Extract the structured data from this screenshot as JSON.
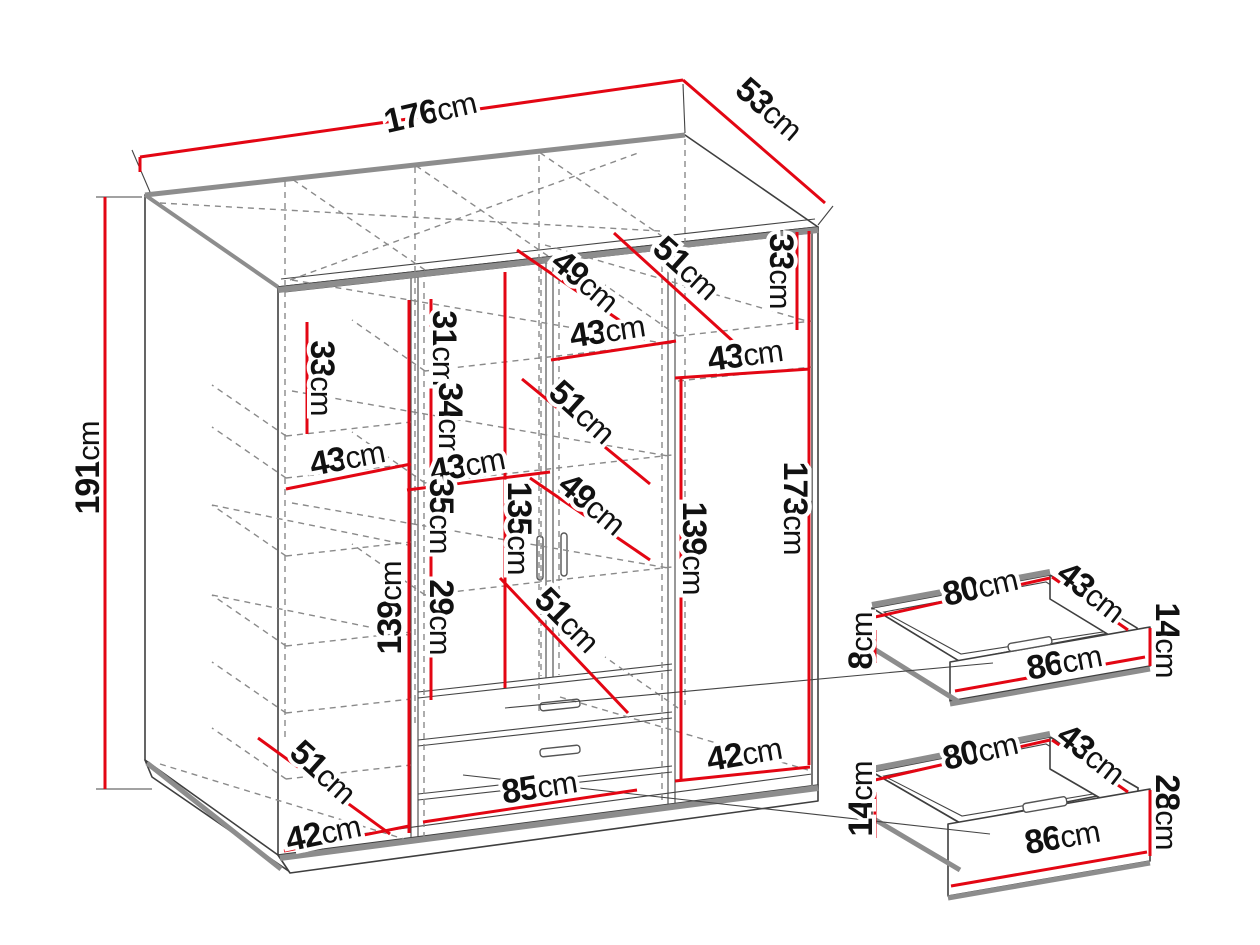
{
  "figure": {
    "kind": "furniture-dimension-diagram",
    "subject": "three-door wardrobe with two drawers and two drawer detail views",
    "unit": "cm"
  },
  "colors": {
    "dimension_red": "#e30613",
    "outline": "#3f3f3f",
    "shadow_gray": "#8d8d8d",
    "dash_gray": "#8a8a8a",
    "background": "#ffffff",
    "text": "#111111"
  },
  "dimensions": [
    {
      "id": "overall-width",
      "value": "176",
      "unit": "cm"
    },
    {
      "id": "overall-depth",
      "value": "53",
      "unit": "cm"
    },
    {
      "id": "overall-height",
      "value": "191",
      "unit": "cm"
    },
    {
      "id": "left-top-compartment-height",
      "value": "33",
      "unit": "cm"
    },
    {
      "id": "left-shelf-width",
      "value": "43",
      "unit": "cm"
    },
    {
      "id": "left-floor-diagonal",
      "value": "51",
      "unit": "cm"
    },
    {
      "id": "bottom-left-width",
      "value": "42",
      "unit": "cm"
    },
    {
      "id": "shelf-gap-31",
      "value": "31",
      "unit": "cm"
    },
    {
      "id": "shelf-gap-34",
      "value": "34",
      "unit": "cm"
    },
    {
      "id": "middle-shelf-width",
      "value": "43",
      "unit": "cm"
    },
    {
      "id": "shelf-gap-35",
      "value": "35",
      "unit": "cm"
    },
    {
      "id": "shelf-gap-29",
      "value": "29",
      "unit": "cm"
    },
    {
      "id": "left-column-height",
      "value": "139",
      "unit": "cm"
    },
    {
      "id": "center-top-shelf-width",
      "value": "43",
      "unit": "cm"
    },
    {
      "id": "top-shelf-diagonal-49",
      "value": "49",
      "unit": "cm"
    },
    {
      "id": "top-shelf-diagonal-51",
      "value": "51",
      "unit": "cm"
    },
    {
      "id": "right-top-compartment-height",
      "value": "33",
      "unit": "cm"
    },
    {
      "id": "middle-shelf-diagonal-51",
      "value": "51",
      "unit": "cm"
    },
    {
      "id": "center-interior-height",
      "value": "135",
      "unit": "cm"
    },
    {
      "id": "middle-shelf-diagonal-49",
      "value": "49",
      "unit": "cm"
    },
    {
      "id": "lower-shelf-diagonal-51",
      "value": "51",
      "unit": "cm"
    },
    {
      "id": "right-inner-height",
      "value": "139",
      "unit": "cm"
    },
    {
      "id": "right-door-height",
      "value": "173",
      "unit": "cm"
    },
    {
      "id": "right-shelf-width",
      "value": "43",
      "unit": "cm"
    },
    {
      "id": "bottom-right-width",
      "value": "42",
      "unit": "cm"
    },
    {
      "id": "bottom-center-width",
      "value": "85",
      "unit": "cm"
    },
    {
      "id": "top-drawer-back-width",
      "value": "80",
      "unit": "cm"
    },
    {
      "id": "top-drawer-depth",
      "value": "43",
      "unit": "cm"
    },
    {
      "id": "top-drawer-front-height",
      "value": "14",
      "unit": "cm"
    },
    {
      "id": "top-drawer-back-height",
      "value": "8",
      "unit": "cm"
    },
    {
      "id": "top-drawer-front-width",
      "value": "86",
      "unit": "cm"
    },
    {
      "id": "bottom-drawer-back-width",
      "value": "80",
      "unit": "cm"
    },
    {
      "id": "bottom-drawer-depth",
      "value": "43",
      "unit": "cm"
    },
    {
      "id": "bottom-drawer-front-height",
      "value": "28",
      "unit": "cm"
    },
    {
      "id": "bottom-drawer-back-height",
      "value": "14",
      "unit": "cm"
    },
    {
      "id": "bottom-drawer-front-width",
      "value": "86",
      "unit": "cm"
    }
  ]
}
